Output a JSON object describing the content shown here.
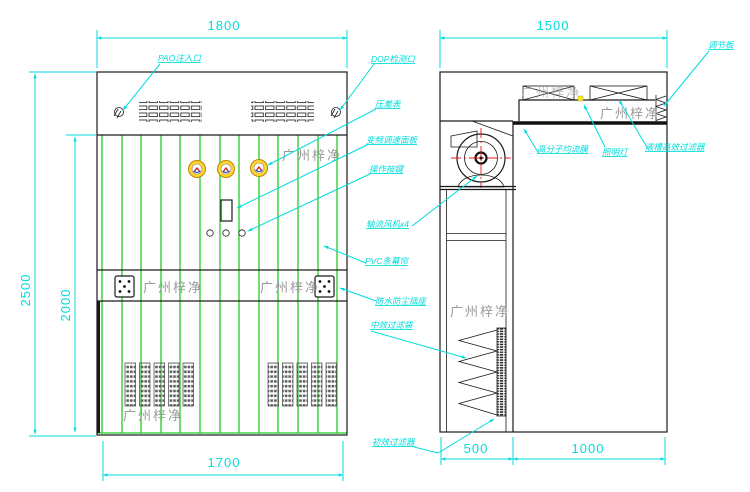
{
  "company": "广州梓净",
  "labels": {
    "pao_port": "PAO注入口",
    "dop_port": "DOP检测口",
    "pressure_gauge": "压差表",
    "vfd_panel": "变频调速面板",
    "control_buttons": "操作按键",
    "fans": "轴流风机x4",
    "pvc_curtain": "PVC条幕帘",
    "waterproof_socket": "防水防尘插座",
    "medium_filter": "中效过滤袋",
    "primary_filter": "初效过滤器",
    "diffuser_membrane": "高分子均流膜",
    "lamp": "照明灯",
    "hepa_filter": "液槽高效过滤器",
    "adjusting_plate": "调节板"
  },
  "dimensions": {
    "front_top_width": "1800",
    "side_top_depth": "1500",
    "total_height": "2500",
    "opening_height": "2000",
    "front_bottom_width": "1700",
    "fan_section_depth": "500",
    "chamber_depth": "1000"
  },
  "colors": {
    "dimension_cyan": "#00dcdc",
    "curtain_green": "#22cc22",
    "structure_black": "#1a1a1a",
    "watermark_gray": "#9a9a9a",
    "gauge_yellow": "#ffd52e",
    "crosshair_red": "#ee1111",
    "lamp_yellow": "#ffee00"
  }
}
